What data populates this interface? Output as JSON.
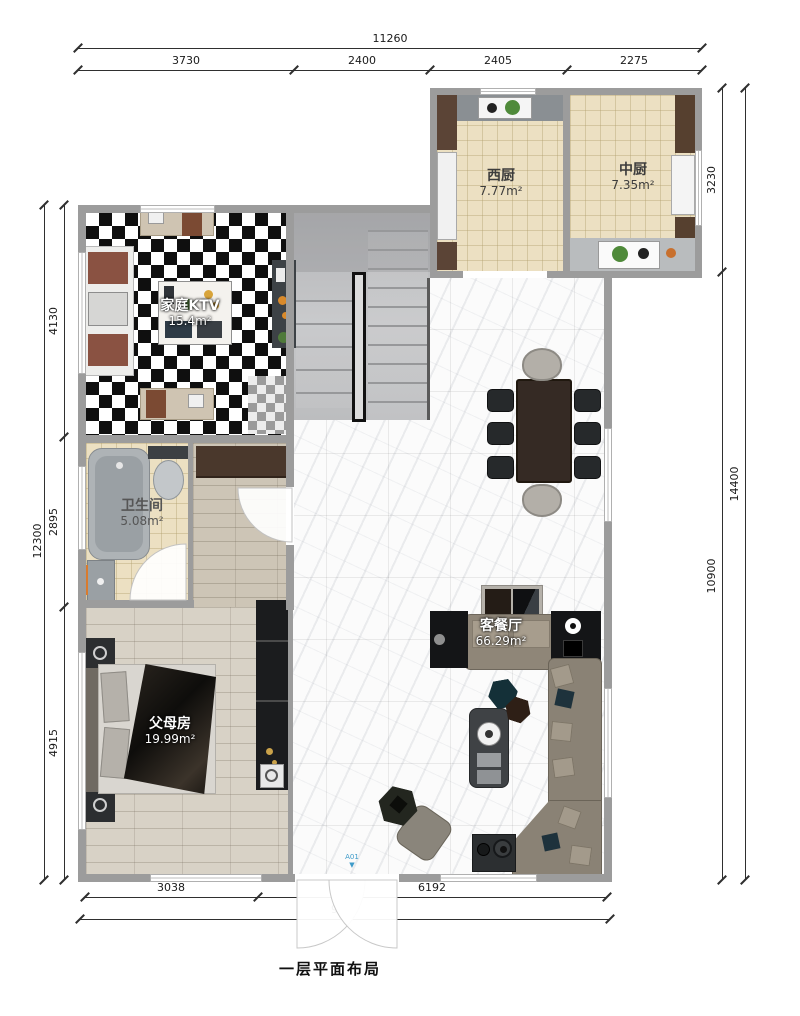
{
  "title": "一层平面布局",
  "door_marker": "A01",
  "rooms": {
    "west_kitchen": {
      "name": "西厨",
      "area": "7.77m²"
    },
    "chinese_kitchen": {
      "name": "中厨",
      "area": "7.35m²"
    },
    "family_ktv": {
      "name": "家庭KTV",
      "area": "15.4m²"
    },
    "bathroom": {
      "name": "卫生间",
      "area": "5.08m²"
    },
    "parents_room": {
      "name": "父母房",
      "area": "19.99m²"
    },
    "living_dining": {
      "name": "客餐厅",
      "area": "66.29m²"
    }
  },
  "dims": {
    "top": {
      "total": "11260",
      "segments": [
        "3730",
        "2400",
        "2405",
        "2275"
      ]
    },
    "left": {
      "total": "12300",
      "segments": [
        "4130",
        "2895",
        "4915"
      ]
    },
    "right": {
      "total": "14400",
      "segments": [
        "3230",
        "10900"
      ]
    },
    "bottom": {
      "total": "9500",
      "segments": [
        "3038",
        "6192"
      ]
    }
  },
  "colors": {
    "wall": "#9c9c9c",
    "dim_text": "#1a1a1a",
    "door_marker": "#3f9bc9",
    "kitchen_floor": "#ece0c2"
  }
}
